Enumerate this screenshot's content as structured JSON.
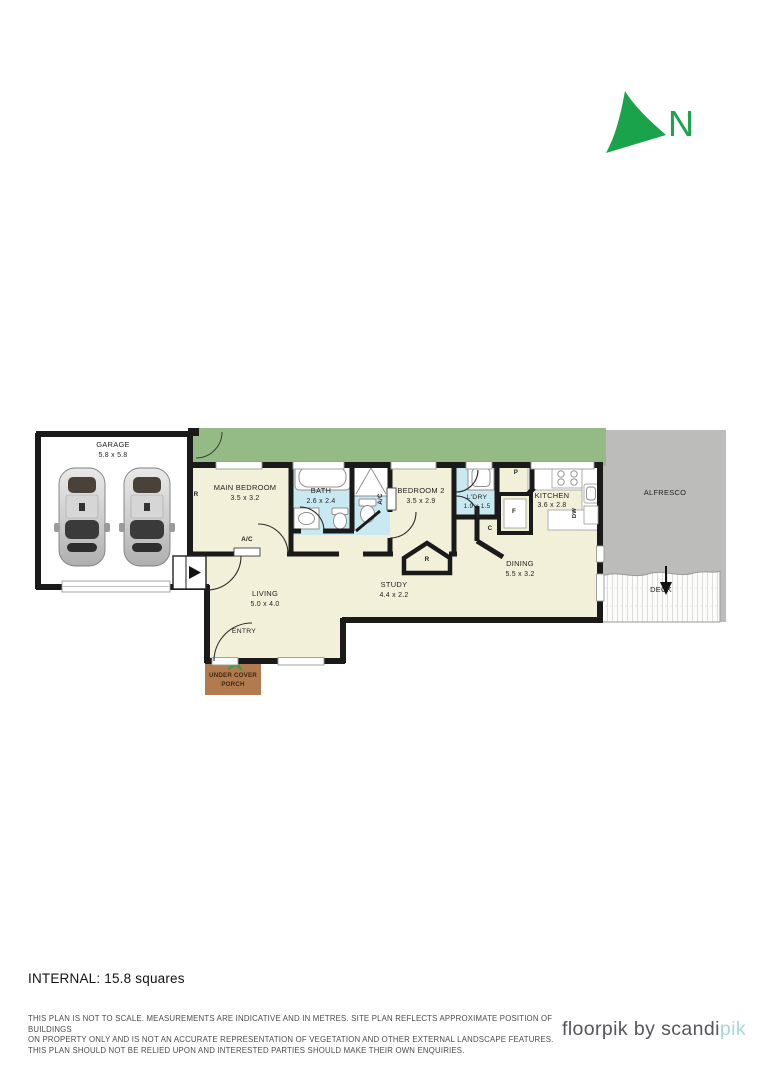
{
  "north_indicator": {
    "label": "N"
  },
  "plan": {
    "rooms": {
      "garage": {
        "name": "GARAGE",
        "dims": "5.8 x 5.8"
      },
      "main_bedroom": {
        "name": "MAIN BEDROOM",
        "dims": "3.5 x 3.2"
      },
      "bath": {
        "name": "BATH",
        "dims": "2.6 x 2.4"
      },
      "bedroom2": {
        "name": "BEDROOM 2",
        "dims": "3.5 x 2.9"
      },
      "laundry": {
        "name": "L'DRY",
        "dims": "1.9 x 1.5"
      },
      "kitchen": {
        "name": "KITCHEN",
        "dims": "3.6 x 2.8"
      },
      "dining": {
        "name": "DINING",
        "dims": "5.5 x 3.2"
      },
      "study": {
        "name": "STUDY",
        "dims": "4.4 x 2.2"
      },
      "living": {
        "name": "LIVING",
        "dims": "5.0 x 4.0"
      },
      "alfresco": {
        "name": "ALFRESCO"
      },
      "deck": {
        "name": "DECK"
      },
      "entry": {
        "name": "ENTRY"
      },
      "porch": {
        "line1": "UNDER COVER",
        "line2": "PORCH"
      }
    },
    "markers": {
      "robe": "R",
      "ac": "A/C",
      "pantry": "P",
      "fridge": "F",
      "cupboard": "C",
      "dishwasher": "DW"
    }
  },
  "footer": {
    "internal": "INTERNAL: 15.8 squares",
    "disclaimer": [
      "THIS PLAN IS NOT TO SCALE. MEASUREMENTS ARE INDICATIVE AND IN METRES. SITE PLAN REFLECTS APPROXIMATE POSITION OF BUILDINGS",
      "ON PROPERTY ONLY AND IS NOT AN ACCURATE REPRESENTATION OF VEGETATION AND OTHER EXTERNAL LANDSCAPE FEATURES.",
      "THIS PLAN SHOULD NOT BE RELIED UPON AND INTERESTED PARTIES SHOULD MAKE THEIR OWN ENQUIRIES."
    ],
    "logo": {
      "primary": "floorpik by scandi",
      "accent": "pik"
    }
  },
  "colors": {
    "grass": "#94bb85",
    "floor": "#f3f0d9",
    "wet_area": "#c9e9f2",
    "alfresco_paving": "#bcbcba",
    "porch": "#b17a4f",
    "wall": "#1a1a1a",
    "north_arrow": "#1aa34a",
    "logo_gray": "#55565a",
    "logo_teal": "#a6d7db"
  }
}
